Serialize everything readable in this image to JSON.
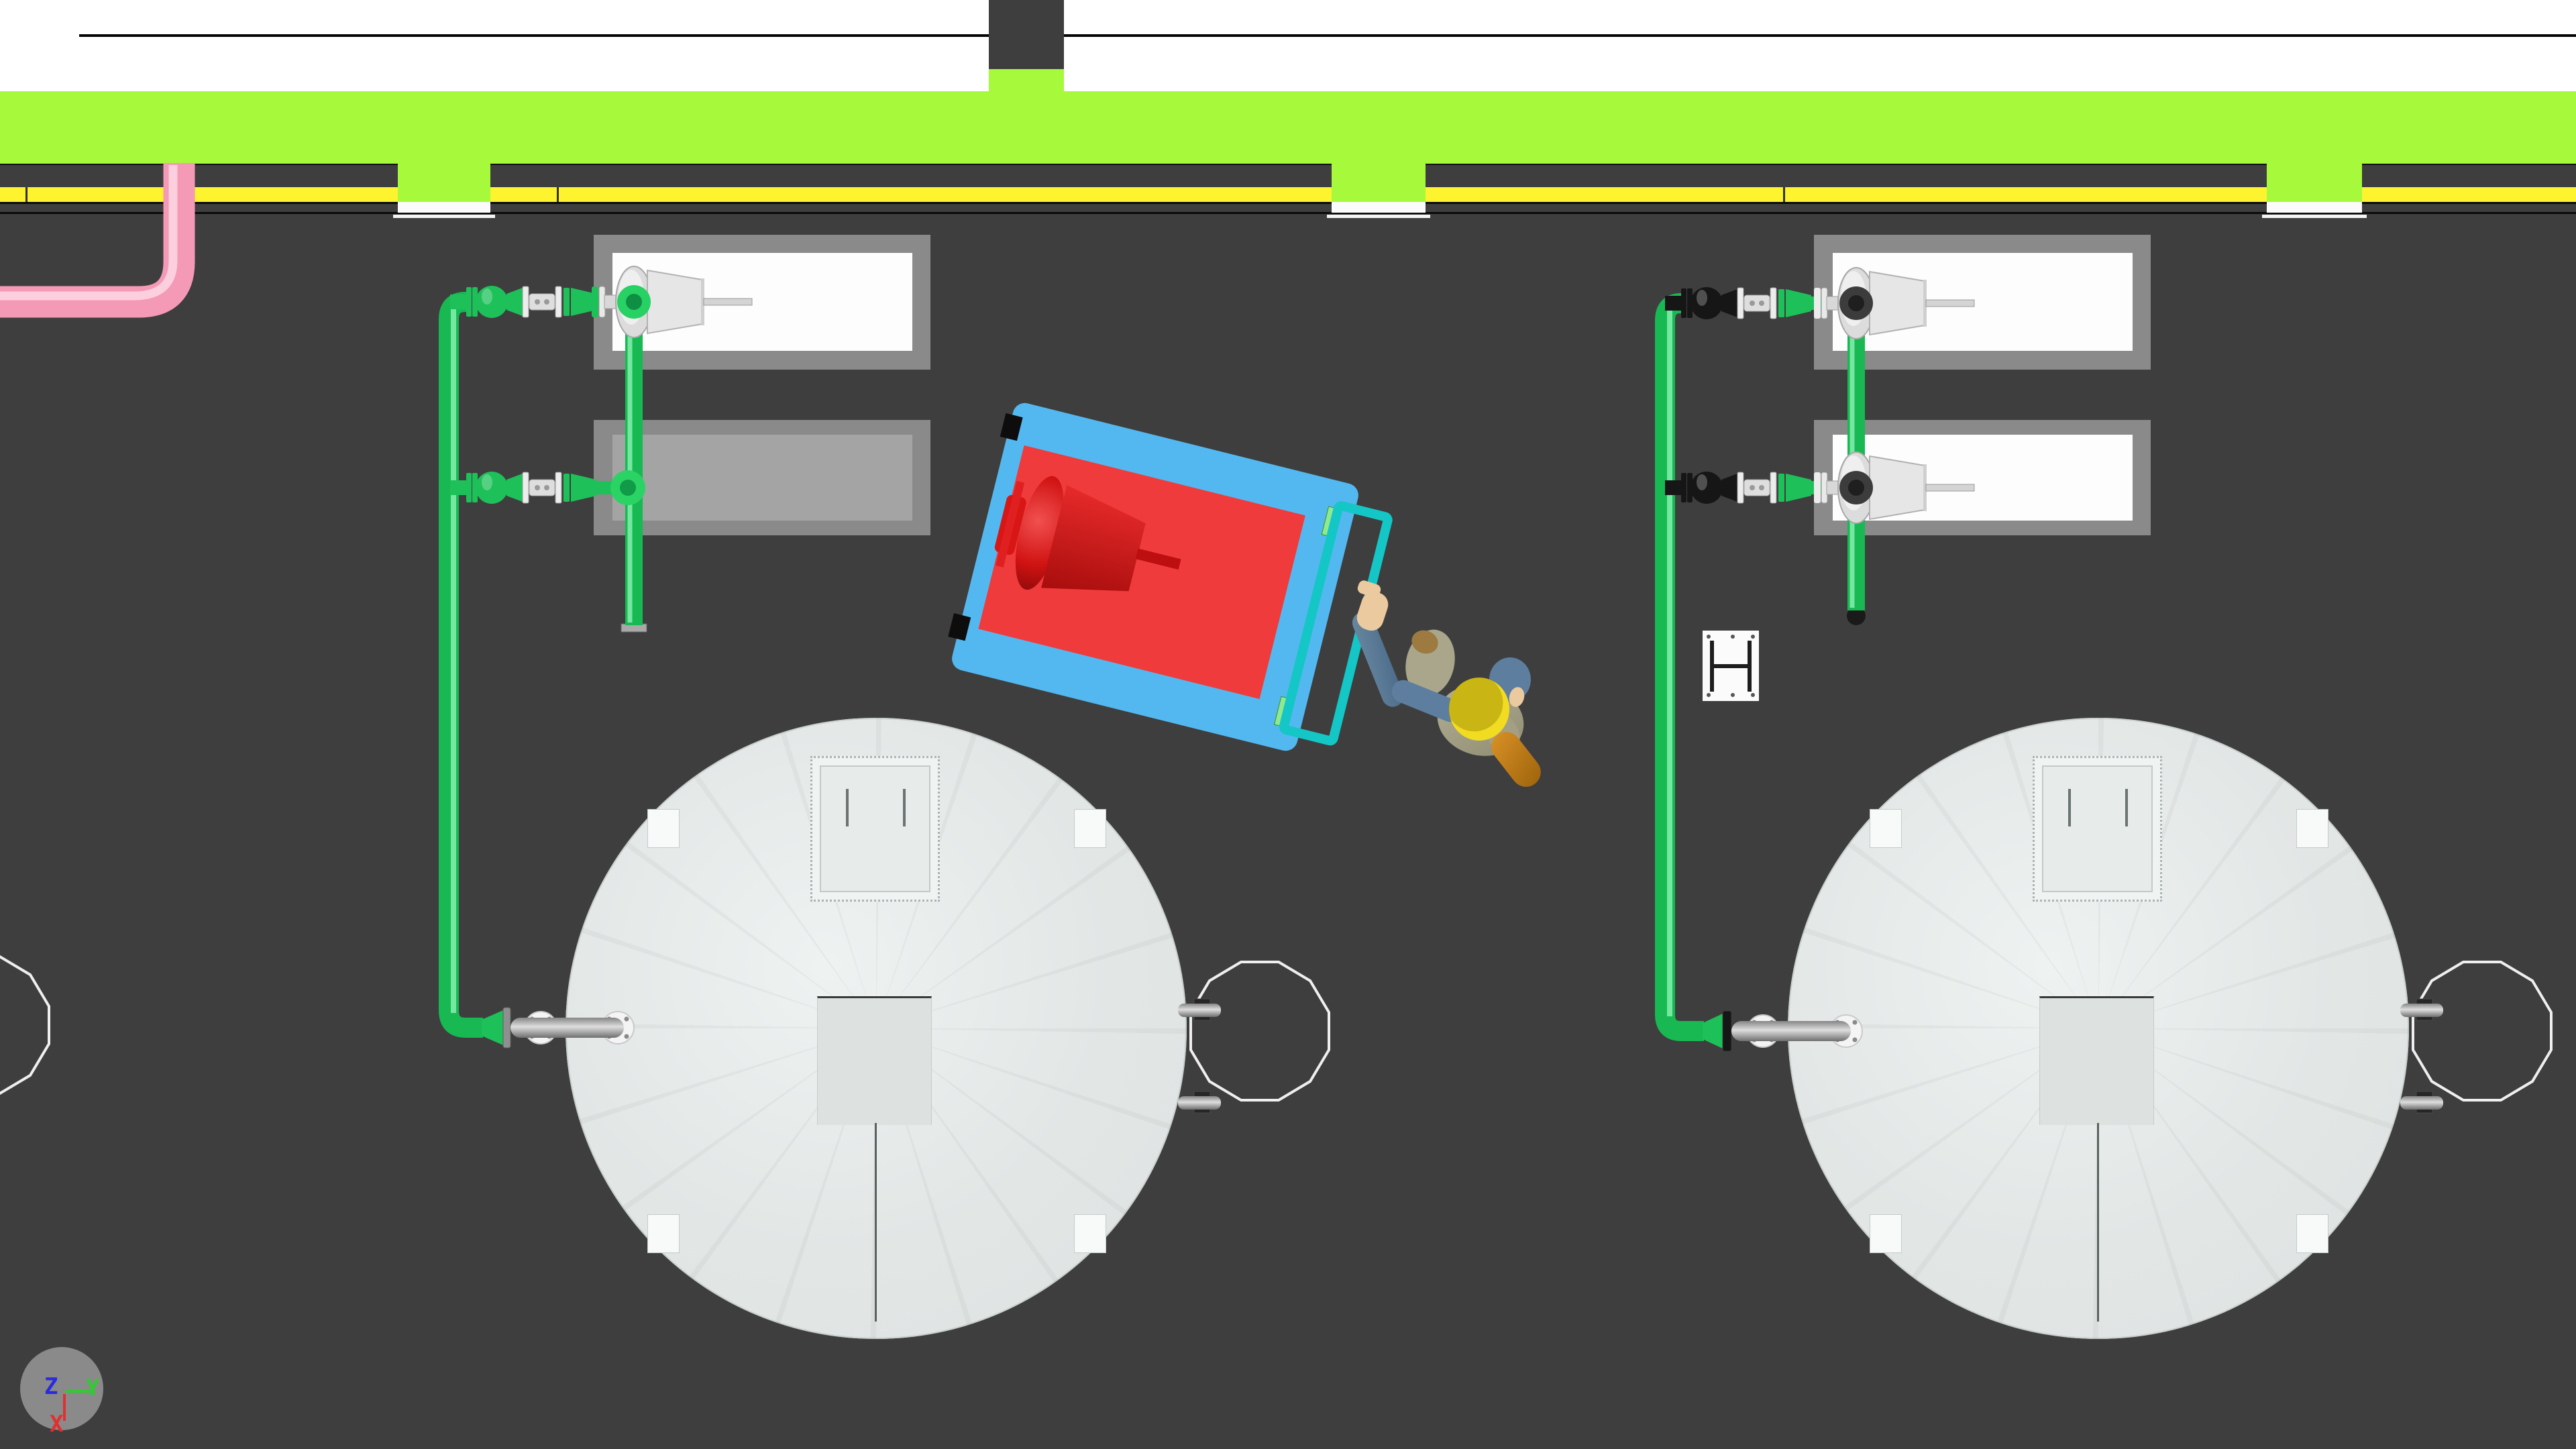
{
  "gizmo": {
    "z_label": "Z",
    "y_label": "Y",
    "x_label": "X"
  },
  "colors": {
    "ground": "#3e3e3e",
    "grass_strip": "#a6f93b",
    "road_marking_yellow": "#fdf32f",
    "sidewalk_white": "#ffffff",
    "pipe_green": "#1ec159",
    "pipe_pink": "#f49ab6",
    "valve_black": "#161616",
    "tank_roof_gray": "#e3e7e6",
    "pump_pad_gray": "#8a8a8a",
    "cart_blue": "#54b8f0",
    "cart_deck_red": "#ef3b3b",
    "cart_pump_red": "#d51515",
    "cart_handle_cyan": "#14c6c6",
    "hardhat_yellow": "#e8d020",
    "axis_x_color": "#e03030",
    "axis_y_color": "#2ecc2e",
    "axis_z_color": "#2a2ae0"
  },
  "scene": {
    "view": "top-down plan",
    "tanks": [
      "storage-tank-1",
      "storage-tank-2"
    ],
    "pump_pads": [
      "pump-pad-left-1",
      "pump-pad-left-2",
      "pump-pad-right-1",
      "pump-pad-right-2"
    ],
    "valve_trains": 4,
    "crosswalks": 3,
    "equipment_cart": "hand-cart-with-red-pump",
    "worker": "worker-with-hard-hat"
  }
}
